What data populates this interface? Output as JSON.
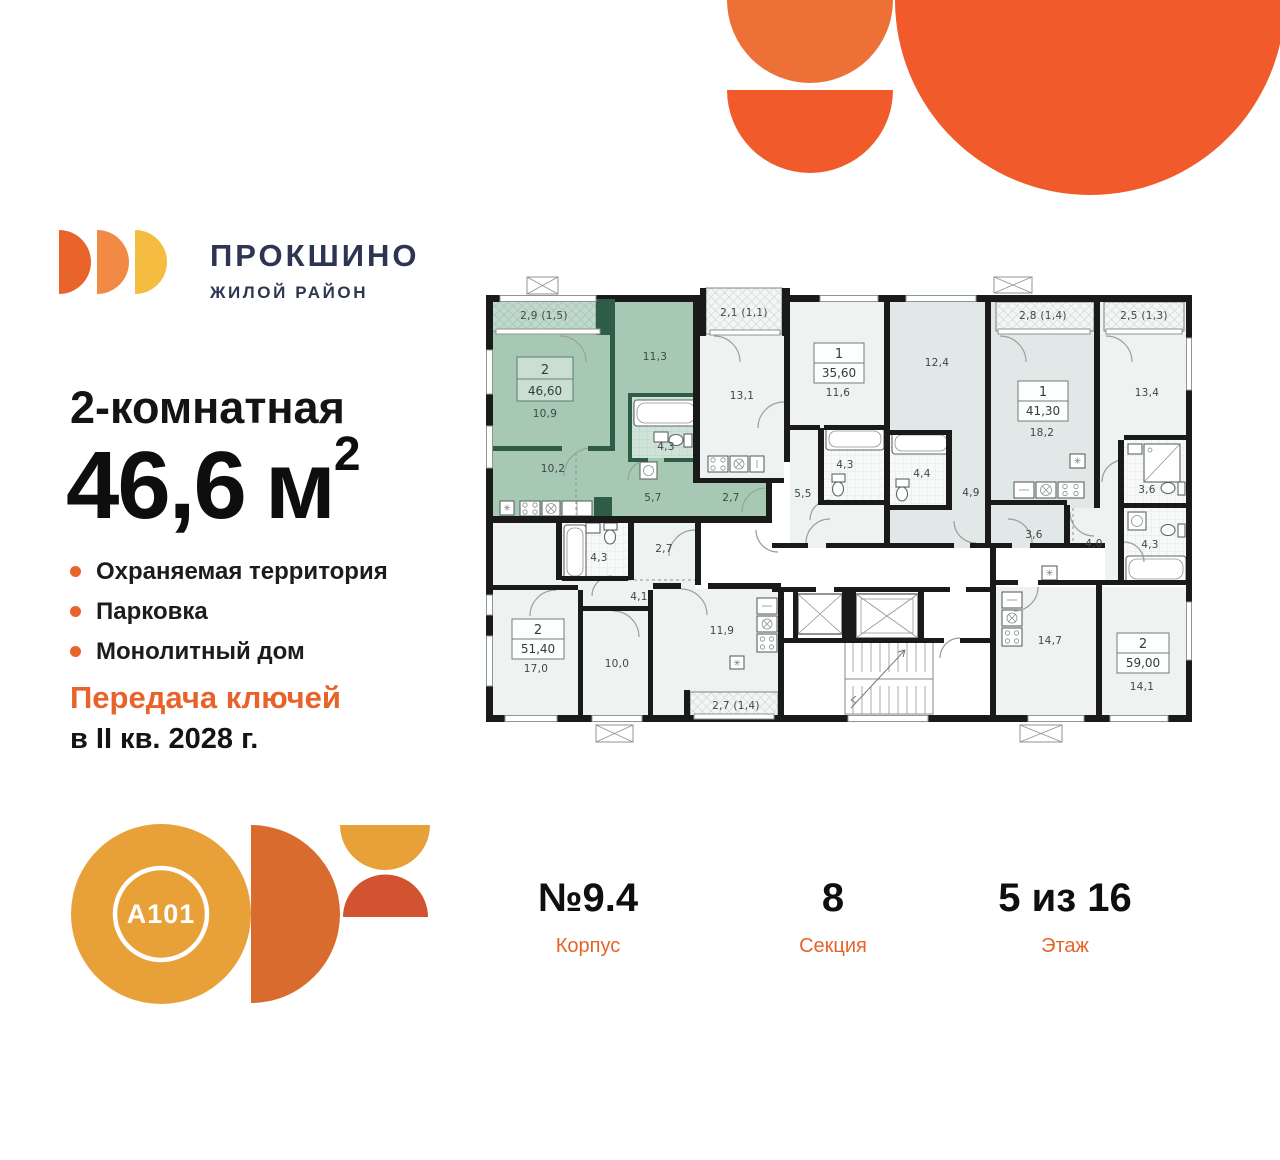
{
  "brand": {
    "name": "ПРОКШИНО",
    "tagline": "ЖИЛОЙ РАЙОН"
  },
  "listing": {
    "title": "2-комнатная",
    "area_value": "46,6",
    "area_unit": "м",
    "area_sup": "2",
    "features": [
      "Охраняемая территория",
      "Парковка",
      "Монолитный дом"
    ],
    "keys_line1": "Передача ключей",
    "keys_line2": "в II кв. 2028 г."
  },
  "developer": {
    "logo_text": "A101"
  },
  "footer": {
    "items": [
      {
        "value": "№9.4",
        "label": "Корпус"
      },
      {
        "value": "8",
        "label": "Секция"
      },
      {
        "value": "5 из 16",
        "label": "Этаж"
      }
    ]
  },
  "floorplan": {
    "highlight": {
      "rooms": "2",
      "area": "46,60",
      "color": "#a7c9b4"
    },
    "labels": [
      {
        "t": "2,9 (1,5)",
        "x": 544,
        "y": 319
      },
      {
        "t": "11,3",
        "x": 655,
        "y": 360
      },
      {
        "t": "10,9",
        "x": 545,
        "y": 417
      },
      {
        "t": "4,3",
        "x": 666,
        "y": 450
      },
      {
        "t": "10,2",
        "x": 553,
        "y": 472
      },
      {
        "t": "5,7",
        "x": 653,
        "y": 501
      },
      {
        "t": "2,7",
        "x": 731,
        "y": 501
      },
      {
        "t": "2,1 (1,1)",
        "x": 744,
        "y": 316
      },
      {
        "t": "13,1",
        "x": 742,
        "y": 399
      },
      {
        "t": "11,6",
        "x": 838,
        "y": 396
      },
      {
        "t": "4,3",
        "x": 845,
        "y": 468
      },
      {
        "t": "5,5",
        "x": 803,
        "y": 497
      },
      {
        "t": "12,4",
        "x": 937,
        "y": 366
      },
      {
        "t": "4,4",
        "x": 922,
        "y": 477
      },
      {
        "t": "4,9",
        "x": 971,
        "y": 496
      },
      {
        "t": "2,8 (1,4)",
        "x": 1043,
        "y": 319
      },
      {
        "t": "18,2",
        "x": 1042,
        "y": 436
      },
      {
        "t": "2,5 (1,3)",
        "x": 1144,
        "y": 319
      },
      {
        "t": "13,4",
        "x": 1147,
        "y": 396
      },
      {
        "t": "3,6",
        "x": 1147,
        "y": 493
      },
      {
        "t": "3,6",
        "x": 1034,
        "y": 538
      },
      {
        "t": "4,0",
        "x": 1094,
        "y": 547
      },
      {
        "t": "4,3",
        "x": 1150,
        "y": 548
      },
      {
        "t": "2,7",
        "x": 664,
        "y": 552
      },
      {
        "t": "4,3",
        "x": 599,
        "y": 561
      },
      {
        "t": "4,1",
        "x": 639,
        "y": 600
      },
      {
        "t": "17,0",
        "x": 536,
        "y": 672
      },
      {
        "t": "10,0",
        "x": 617,
        "y": 667
      },
      {
        "t": "11,9",
        "x": 722,
        "y": 634
      },
      {
        "t": "2,7 (1,4)",
        "x": 736,
        "y": 709
      },
      {
        "t": "14,7",
        "x": 1050,
        "y": 644
      },
      {
        "t": "14,1",
        "x": 1142,
        "y": 690
      }
    ],
    "units": [
      {
        "num": "2",
        "area": "46,60",
        "x": 517,
        "y": 357,
        "w": 56,
        "h": 44,
        "green": true
      },
      {
        "num": "1",
        "area": "35,60",
        "x": 814,
        "y": 343,
        "w": 50,
        "h": 40
      },
      {
        "num": "1",
        "area": "41,30",
        "x": 1018,
        "y": 381,
        "w": 50,
        "h": 40
      },
      {
        "num": "2",
        "area": "51,40",
        "x": 512,
        "y": 619,
        "w": 52,
        "h": 40
      },
      {
        "num": "2",
        "area": "59,00",
        "x": 1117,
        "y": 633,
        "w": 52,
        "h": 40
      }
    ]
  }
}
